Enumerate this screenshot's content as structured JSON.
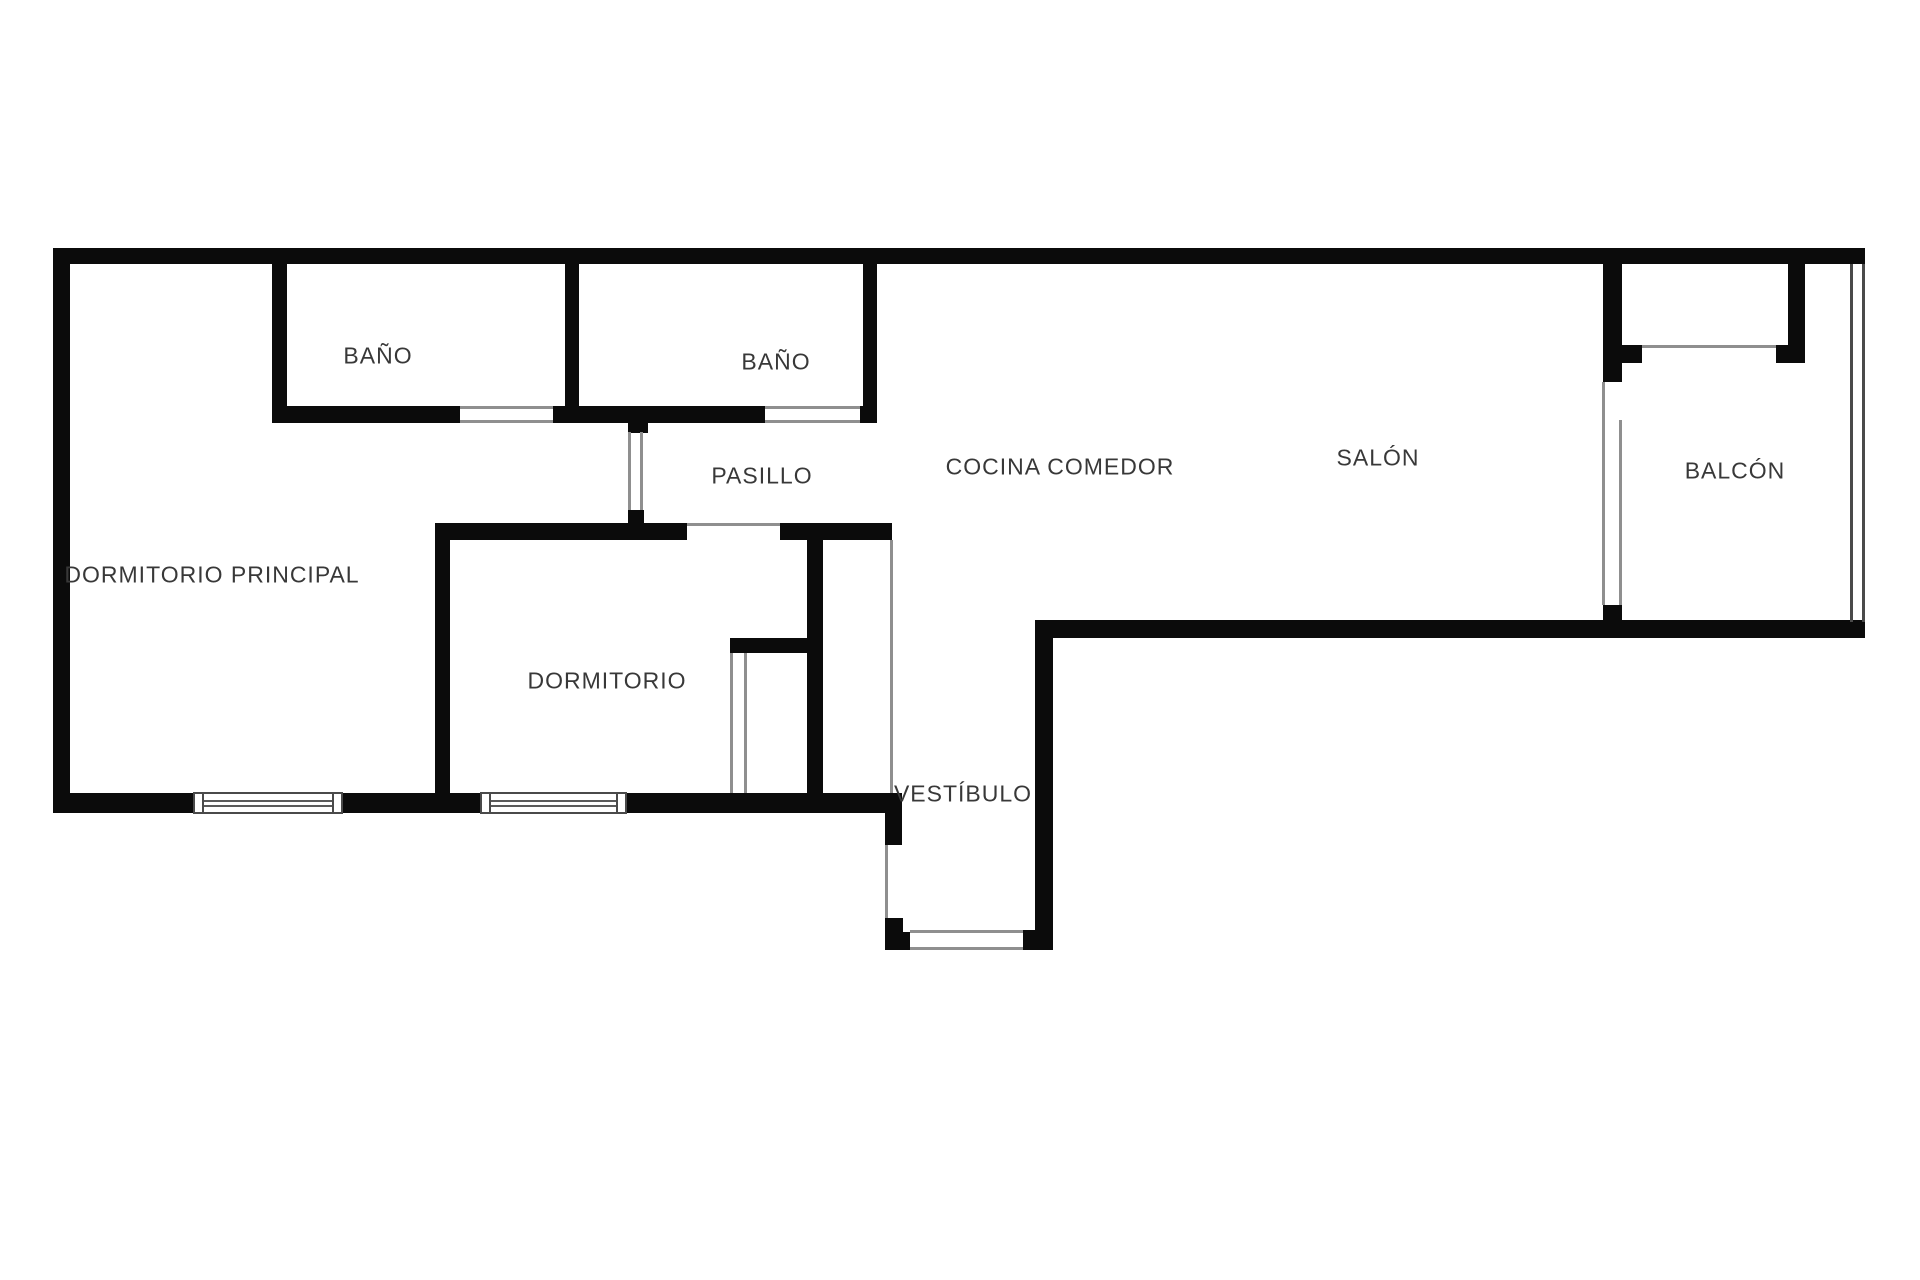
{
  "palette": {
    "wall": "#0b0b0b",
    "thin_line": "#8f8f8f",
    "window_line": "#4a4a4a",
    "label_text": "#383838",
    "background": "#ffffff"
  },
  "rooms": {
    "bano1": "BAÑO",
    "bano2": "BAÑO",
    "pasillo": "PASILLO",
    "cocina_comedor": "COCINA COMEDOR",
    "salon": "SALÓN",
    "balcon": "BALCÓN",
    "dormitorio_principal": "DORMITORIO PRINCIPAL",
    "dormitorio": "DORMITORIO",
    "vestibulo": "VESTÍBULO"
  }
}
